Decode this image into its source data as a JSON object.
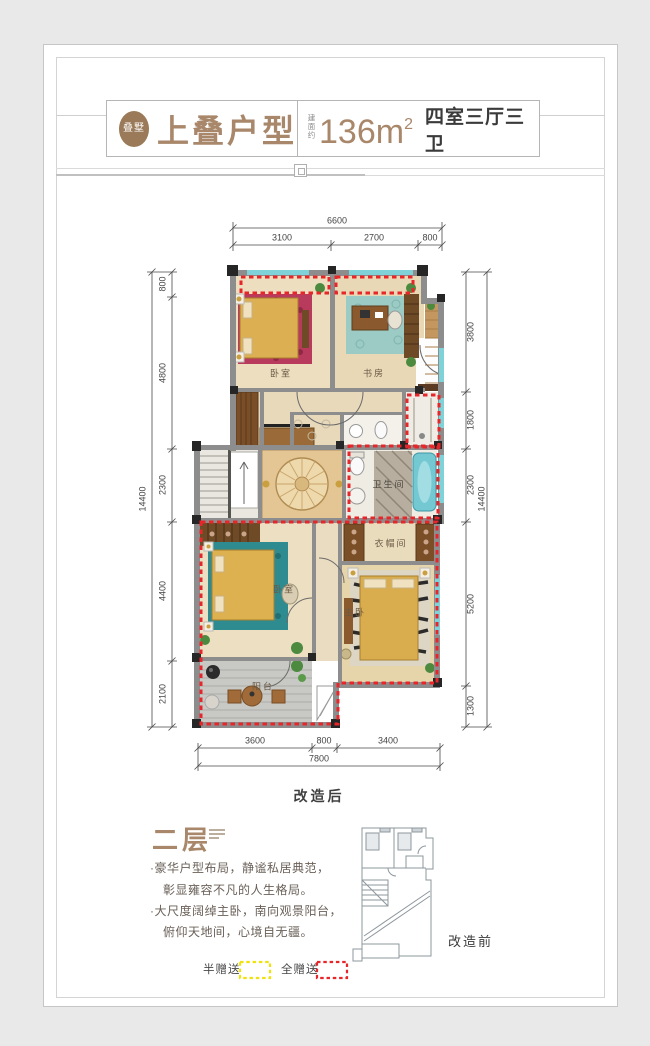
{
  "header": {
    "seal": "叠墅",
    "title": "上叠户型",
    "area_label": "建面约",
    "area_value": "136m",
    "area_exp": "2",
    "spec": "四室三厅三卫"
  },
  "plan": {
    "top": {
      "total": "6600",
      "segs": [
        "3100",
        "2700",
        "800"
      ]
    },
    "left": {
      "total": "14400",
      "segs": [
        "800",
        "4800",
        "2300",
        "4400",
        "2100"
      ]
    },
    "right": {
      "total": "14400",
      "segs": [
        "3800",
        "1800",
        "2300",
        "5200",
        "1300"
      ]
    },
    "bottom": {
      "total": "7800",
      "segs": [
        "3600",
        "800",
        "3400"
      ]
    },
    "rooms": {
      "bedroom_top": "卧室",
      "study": "书房",
      "bathroom": "卫生间",
      "cloakroom": "衣帽间",
      "bedroom_low": "卧室",
      "master": "主卧",
      "balcony": "阳台"
    },
    "caption": "改造后"
  },
  "section": {
    "title": "二层",
    "lines": [
      "·豪华户型布局，静谧私居典范，",
      "彰显雍容不凡的人生格局。",
      "·大尺度阔绰主卧，南向观景阳台，",
      "俯仰天地间，心境自无疆。"
    ],
    "mini_caption": "改造前"
  },
  "legend": {
    "half": "半赠送",
    "full": "全赠送"
  },
  "colors": {
    "brand_brown": "#a8876a",
    "gift_full": "#e8262a",
    "gift_half": "#f0e20c",
    "window_cyan": "#7fd2d8"
  }
}
